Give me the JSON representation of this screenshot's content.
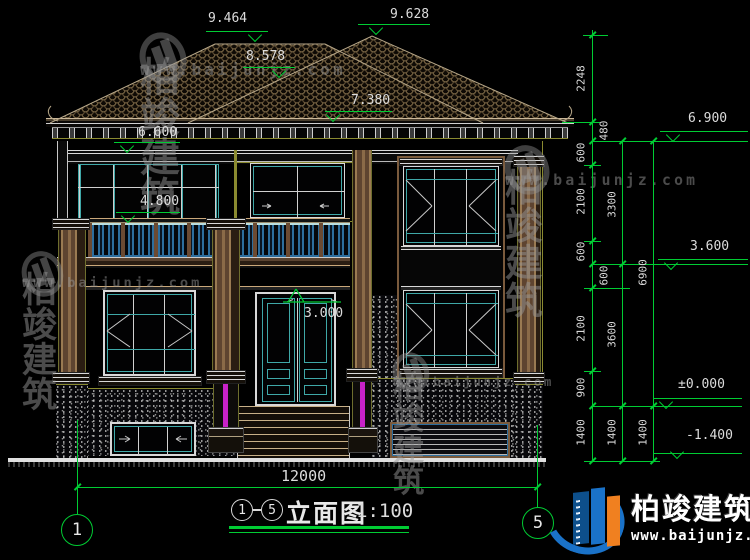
{
  "brand": {
    "name": "柏竣建筑",
    "url": "www.baijunjz.com"
  },
  "title_block": {
    "grid_from": "1",
    "grid_to": "5",
    "drawing_name": "立面图",
    "scale": "1:100"
  },
  "grid_bubbles": {
    "left": "1",
    "right": "5"
  },
  "elevations": {
    "ridge_left": "9.464",
    "ridge_right": "9.628",
    "roof_mid": "8.578",
    "eave_upper": "7.380",
    "eave_left": "6.600",
    "balcony_window_top": "4.800",
    "door_head": "3.000",
    "right_wall_top": "6.900",
    "second_floor": "3.600",
    "ground_floor": "±0.000",
    "site_level": "-1.400"
  },
  "dims": {
    "total_width": "12000",
    "detail_chain": [
      "2248",
      "480",
      "600",
      "2100",
      "600",
      "600",
      "2100",
      "900",
      "1400"
    ],
    "floor_chain": [
      "3300",
      "3600",
      "1400"
    ],
    "overall_chain": [
      "6900",
      "1400"
    ]
  },
  "colors": {
    "background": "#000000",
    "dimension_green": "#00cc33",
    "text_white": "#e8e8e8",
    "window_teal": "#3fa8a8",
    "railing_blue": "#2d6e9e",
    "column_brown": "#6b4c34",
    "accent_magenta": "#c822c8",
    "trim_olive": "#8a8a30",
    "logo_blue": "#1a72c8",
    "logo_orange": "#f08020"
  }
}
